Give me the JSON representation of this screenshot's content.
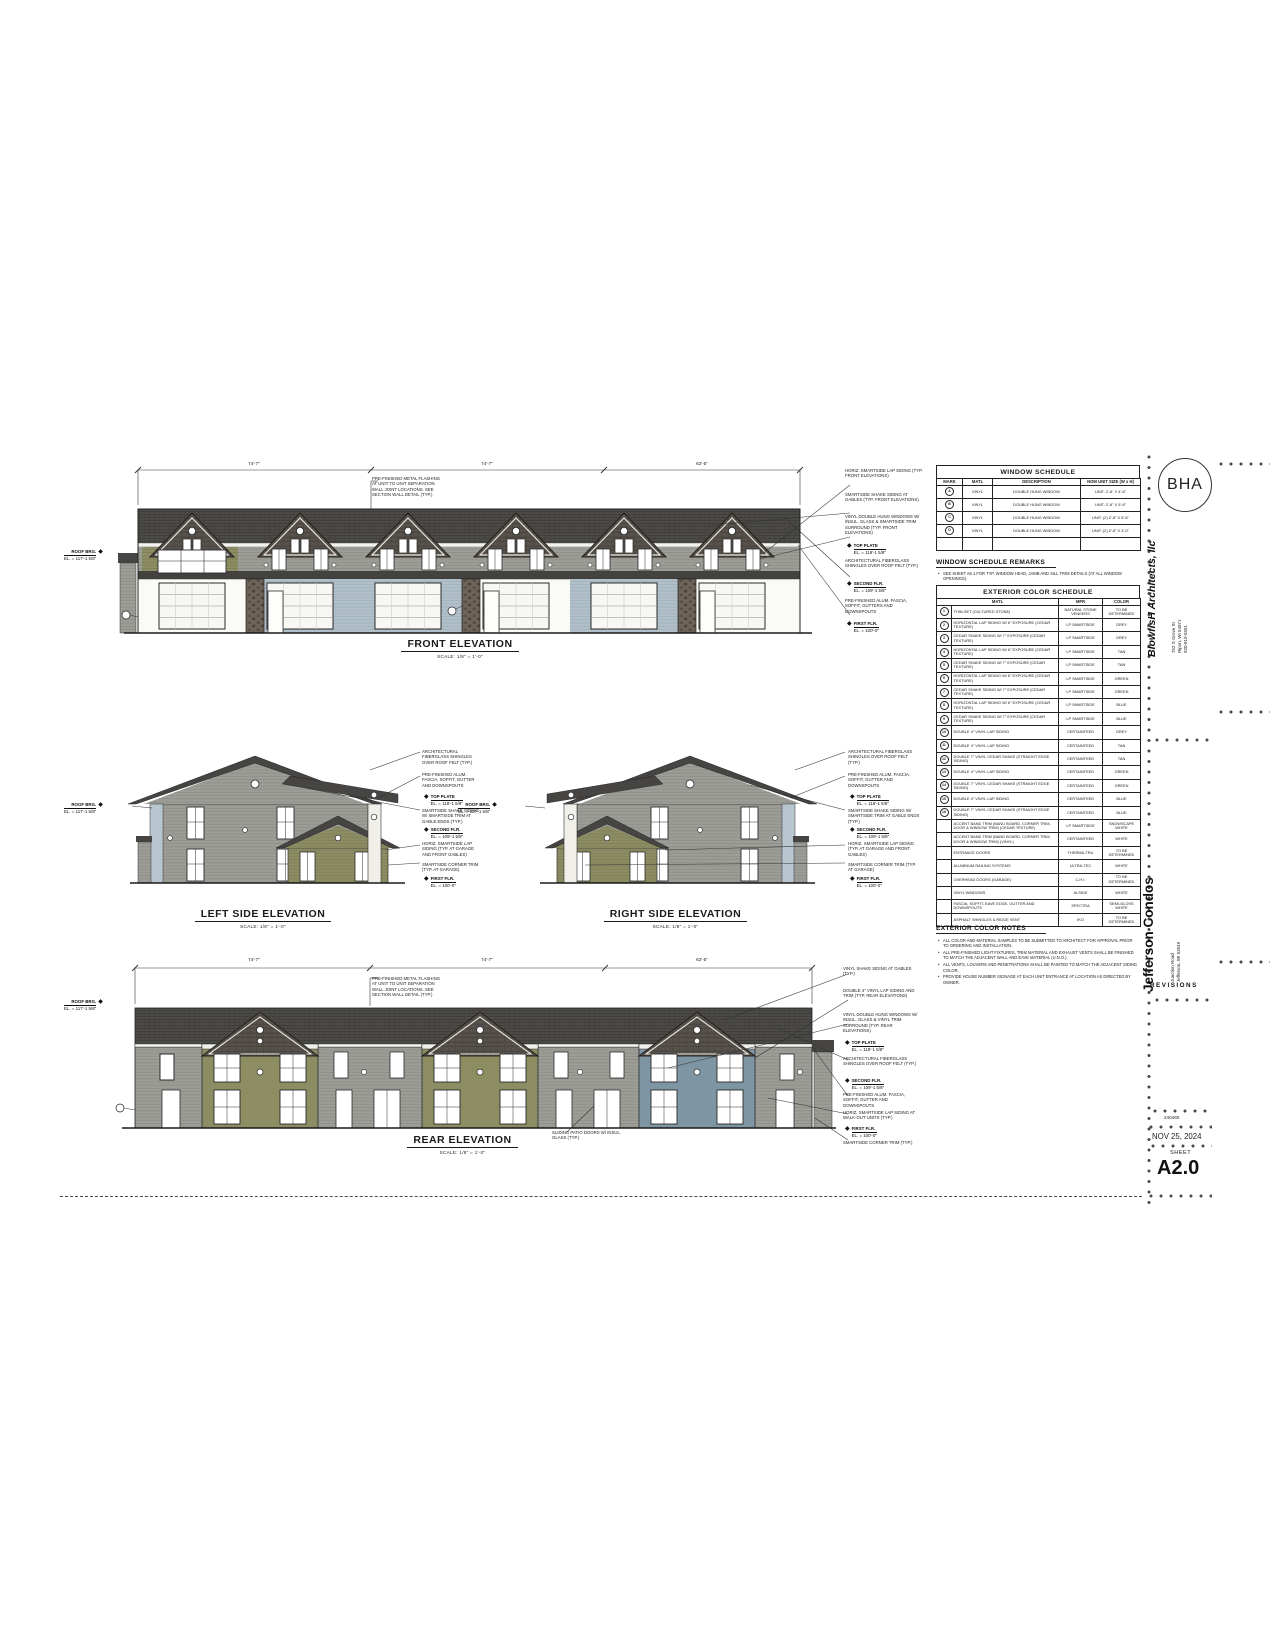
{
  "sheet": {
    "logo": "BHA",
    "firm": "BlowfisH Architects, llc",
    "firm_address": [
      "752 S Grove St",
      "Ripon, WI 54971",
      "920-810-5561"
    ],
    "project": "Jefferson Condos",
    "project_address": [
      "Junction Road",
      "Jefferson, WI 53549"
    ],
    "revisions_label": "REVISIONS",
    "project_number": "240460",
    "date": "NOV 25, 2024",
    "sheet_label": "SHEET",
    "sheet_number": "A2.0"
  },
  "elevations": {
    "front": {
      "title": "FRONT ELEVATION",
      "scale": "SCALE: 1/8\" = 1'-0\""
    },
    "left": {
      "title": "LEFT SIDE ELEVATION",
      "scale": "SCALE: 1/8\" = 1'-0\""
    },
    "right": {
      "title": "RIGHT SIDE ELEVATION",
      "scale": "SCALE: 1/8\" = 1'-0\""
    },
    "rear": {
      "title": "REAR ELEVATION",
      "scale": "SCALE: 1/8\" = 1'-0\""
    }
  },
  "dims": {
    "front": [
      "74'-7\"",
      "74'-7\"",
      "62'-5\""
    ],
    "rear": [
      "74'-7\"",
      "74'-7\"",
      "62'-5\""
    ]
  },
  "levels": {
    "roof_brg": {
      "label": "ROOF BRG.",
      "el": "EL. = 117'-1 5/8\""
    },
    "top_plate": {
      "label": "TOP PLATE",
      "el": "EL. = 118'-1 5/8\""
    },
    "second": {
      "label": "SECOND FLR.",
      "el": "EL. = 109'-1 5/8\""
    },
    "first": {
      "label": "FIRST FLR.",
      "el": "EL. = 100'-0\""
    }
  },
  "ann": {
    "flash": "PRE-FINISHED METAL FLASHING AT UNIT TO UNIT SEPARATION WALL JOINT LOCATIONS. SEE SECTION WALL DETAIL (TYP.)",
    "front": [
      "HORIZ. SMARTSIDE LAP SIDING (TYP. FRONT ELEVATIONS)",
      "SMARTSIDE SHAKE SIDING AT GABLES (TYP. FRONT ELEVATIONS)",
      "VINYL DOUBLE HUNG WINDOWS W/ INSUL. GLASS & SMARTSIDE TRIM SURROUND (TYP. FRONT ELEVATIONS)",
      "ARCHITECTURAL FIBERGLASS SHINGLES OVER ROOF FELT (TYP.)",
      "PRE-FINISHED ALUM. FASCIA, SOFFIT, GUTTERS AND DOWNSPOUTS"
    ],
    "side": [
      "ARCHITECTURAL FIBERGLASS SHINGLES OVER ROOF FELT (TYP.)",
      "PRE-FINISHED ALUM. FASCIA, SOFFIT, GUTTER AND DOWNSPOUTS",
      "SMARTSIDE SHAKE SIDING W/ SMARTSIDE TRIM AT GABLE ENDS (TYP.)",
      "HORIZ. SMARTSIDE LAP SIDING (TYP. AT GARAGE AND FRONT GABLES)",
      "SMARTSIDE CORNER TRIM (TYP. AT GARAGE)"
    ],
    "rear": [
      "VINYL SHAKE SIDING AT GABLES (TYP.)",
      "DOUBLE 4\" VINYL LAP SIDING AND TRIM (TYP. REAR ELEVATIONS)",
      "VINYL DOUBLE HUNG WINDOWS W/ INSUL. GLASS & VINYL TRIM SURROUND (TYP. REAR ELEVATIONS)",
      "ARCHITECTURAL FIBERGLASS SHINGLES OVER ROOF FELT (TYP.)",
      "PRE-FINISHED ALUM. FASCIA, SOFFIT, GUTTER AND DOWNSPOUTS",
      "HORIZ. SMARTSIDE LAP SIDING AT WALK-OUT UNITS (TYP.)",
      "SMARTSIDE CORNER TRIM (TYP.)"
    ],
    "rear_patio": "SLIDING PATIO DOORS W/ INSUL. GLASS (TYP.)"
  },
  "window_schedule": {
    "title": "WINDOW SCHEDULE",
    "headers": [
      "MARK",
      "MATL",
      "DESCRIPTION",
      "NOM UNIT SIZE (W x H)"
    ],
    "rows": [
      {
        "mark": "A",
        "matl": "VINYL",
        "desc": "DOUBLE HUNG WINDOW",
        "size": "UNIT: 2'-8\" x 4'-6\""
      },
      {
        "mark": "B",
        "matl": "VINYL",
        "desc": "DOUBLE HUNG WINDOW",
        "size": "UNIT: 2'-8\" x 5'-6\""
      },
      {
        "mark": "C",
        "matl": "VINYL",
        "desc": "DOUBLE HUNG WINDOW",
        "size": "UNIT: (2) 2'-8\" x 5'-6\""
      },
      {
        "mark": "D",
        "matl": "VINYL",
        "desc": "DOUBLE HUNG WINDOW",
        "size": "UNIT: (2) 2'-8\" x 3'-0\""
      },
      {
        "mark": "",
        "matl": "",
        "desc": "",
        "size": ""
      }
    ],
    "remarks_title": "WINDOW SCHEDULE REMARKS",
    "remarks": [
      "SEE SHEET A6.1 FOR TYP. WINDOW HEAD, JAMB AND SILL TRIM DETAILS (AT ALL WINDOW OPENINGS)."
    ]
  },
  "exterior_schedule": {
    "title": "EXTERIOR COLOR SCHEDULE",
    "headers": [
      "MATL",
      "MFR",
      "COLOR"
    ],
    "rows": [
      {
        "mark": "1",
        "matl": "THIN-SET (CULTURED STONE)",
        "mfr": "NATURAL STONE VENEERS",
        "color": "TO BE DETERMINED"
      },
      {
        "mark": "2",
        "matl": "HORIZONTAL LAP SIDING W/ 6\" EXPOSURE (CEDAR TEXTURE)",
        "mfr": "LP SMARTSIDE",
        "color": "GREY"
      },
      {
        "mark": "3",
        "matl": "CEDAR SHAKE SIDING W/ 7\" EXPOSURE (CEDAR TEXTURE)",
        "mfr": "LP SMARTSIDE",
        "color": "GREY"
      },
      {
        "mark": "4",
        "matl": "HORIZONTAL LAP SIDING W/ 6\" EXPOSURE (CEDAR TEXTURE)",
        "mfr": "LP SMARTSIDE",
        "color": "TAN"
      },
      {
        "mark": "5",
        "matl": "CEDAR SHAKE SIDING W/ 7\" EXPOSURE (CEDAR TEXTURE)",
        "mfr": "LP SMARTSIDE",
        "color": "TAN"
      },
      {
        "mark": "6",
        "matl": "HORIZONTAL LAP SIDING W/ 6\" EXPOSURE (CEDAR TEXTURE)",
        "mfr": "LP SMARTSIDE",
        "color": "GREEN"
      },
      {
        "mark": "7",
        "matl": "CEDAR SHAKE SIDING W/ 7\" EXPOSURE (CEDAR TEXTURE)",
        "mfr": "LP SMARTSIDE",
        "color": "GREEN"
      },
      {
        "mark": "8",
        "matl": "HORIZONTAL LAP SIDING W/ 6\" EXPOSURE (CEDAR TEXTURE)",
        "mfr": "LP SMARTSIDE",
        "color": "BLUE"
      },
      {
        "mark": "9",
        "matl": "CEDAR SHAKE SIDING W/ 7\" EXPOSURE (CEDAR TEXTURE)",
        "mfr": "LP SMARTSIDE",
        "color": "BLUE"
      },
      {
        "mark": "10",
        "matl": "DOUBLE 4\" VINYL LAP SIDING",
        "mfr": "CERTAINTEED",
        "color": "GREY"
      },
      {
        "mark": "11",
        "matl": "DOUBLE 4\" VINYL LAP SIDING",
        "mfr": "CERTAINTEED",
        "color": "TAN"
      },
      {
        "mark": "12",
        "matl": "DOUBLE 7\" VINYL CEDAR SHAKE (STRAIGHT EDGE SIDING)",
        "mfr": "CERTAINTEED",
        "color": "TAN"
      },
      {
        "mark": "13",
        "matl": "DOUBLE 4\" VINYL LAP SIDING",
        "mfr": "CERTAINTEED",
        "color": "GREEN"
      },
      {
        "mark": "14",
        "matl": "DOUBLE 7\" VINYL CEDAR SHAKE (STRAIGHT EDGE SIDING)",
        "mfr": "CERTAINTEED",
        "color": "GREEN"
      },
      {
        "mark": "15",
        "matl": "DOUBLE 4\" VINYL LAP SIDING",
        "mfr": "CERTAINTEED",
        "color": "BLUE"
      },
      {
        "mark": "16",
        "matl": "DOUBLE 7\" VINYL CEDAR SHAKE (STRAIGHT EDGE SIDING)",
        "mfr": "CERTAINTEED",
        "color": "BLUE"
      },
      {
        "mark": "",
        "matl": "ACCENT BAND TRIM (BAND BOARD, CORNER TRIM, DOOR & WINDOW TRIM) (CEDAR TEXTURE)",
        "mfr": "LP SMARTSIDE",
        "color": "SNOWSCAPE WHITE"
      },
      {
        "mark": "",
        "matl": "ACCENT BAND TRIM (BAND BOARD, CORNER TRIM, DOOR & WINDOW TRIM) (VINYL)",
        "mfr": "CERTAINTEED",
        "color": "WHITE"
      },
      {
        "mark": "",
        "matl": "ENTRANCE DOORS",
        "mfr": "THERMA-TRU",
        "color": "TO BE DETERMINED"
      },
      {
        "mark": "",
        "matl": "ALUMINUM RAILING SYSTEMS",
        "mfr": "ULTRA-TEC",
        "color": "WHITE"
      },
      {
        "mark": "",
        "matl": "OVERHEAD DOORS (GARAGE)",
        "mfr": "C.H.I.",
        "color": "TO BE DETERMINED"
      },
      {
        "mark": "",
        "matl": "VINYL WINDOWS",
        "mfr": "ALSIDE",
        "color": "WHITE"
      },
      {
        "mark": "",
        "matl": "FASCIA, SOFFIT, EAVE EDGE, GUTTER AND DOWNSPOUTS",
        "mfr": "SPECTRA",
        "color": "SEMI-GLOSS WHITE"
      },
      {
        "mark": "",
        "matl": "ASPHALT SHINGLES & RIDGE VENT",
        "mfr": "IKO",
        "color": "TO BE DETERMINED"
      }
    ]
  },
  "color_notes": {
    "title": "EXTERIOR COLOR NOTES",
    "items": [
      "ALL COLOR AND MATERIAL SAMPLES TO BE SUBMITTED TO ARCHITECT FOR APPROVAL PRIOR TO ORDERING AND INSTALLATION.",
      "ALL PRE-FINISHED LIGHT FIXTURES, TRIM MATERIAL AND EXHAUST VENTS SHALL BE FINISHED TO MATCH THE ADJACENT WALL AND EAVE MATERIAL (U.N.O.).",
      "ALL VENTS, LOUVERS AND PENETRATIONS SHALL BE PAINTED TO MATCH THE ADJACENT SIDING COLOR.",
      "PROVIDE HOUSE NUMBER SIGNAGE AT EACH UNIT ENTRANCE AT LOCATION AS DIRECTED BY OWNER."
    ]
  },
  "palette": {
    "roof": "#474543",
    "shake": "#57514b",
    "siding_grey": "#9d9d97",
    "siding_olive": "#8d8d64",
    "siding_blue": "#7e95a3",
    "siding_light_blue": "#b0bfc8",
    "stone": "#6e6459",
    "trim_white": "#f0efe9",
    "ink": "#222222",
    "paper": "#ffffff"
  }
}
